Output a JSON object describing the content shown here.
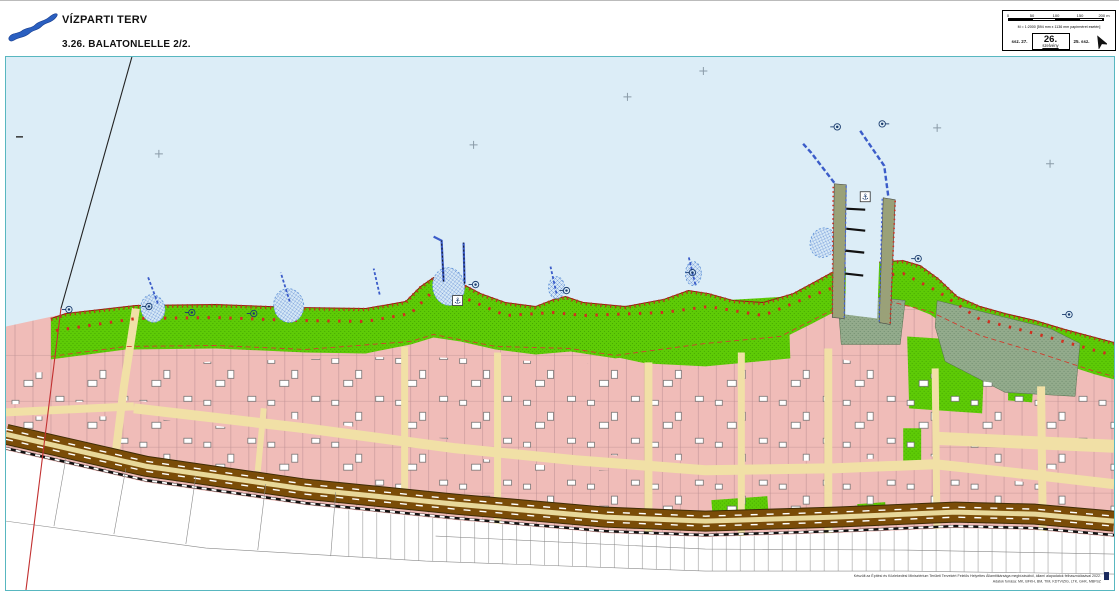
{
  "header": {
    "title": "VÍZPARTI TERV",
    "subtitle": "3.26. BALATONLELLE  2/2."
  },
  "titleblock": {
    "scale_ticks": [
      "0",
      "50",
      "100",
      "150",
      "200 m"
    ],
    "scale_note": "M = 1:2000 [594 mm x 1136 mm papírméret esetén]",
    "prev_sheet": "ssz. 27.",
    "sheet_number": "26.",
    "sheet_label": "szelvény",
    "next_sheet": "25. ssz."
  },
  "map": {
    "credit_line1": "Készült az Építési és Közlekedési Minisztérium Területi Tervekért Felelős Helyettes Államtitkársága megbízásából, állami alapadatok felhasználásával 2022.",
    "credit_line2": "Adatok forrása: MK, BFKH, BM, TIM, KDTVIZIG, LTK, GHK, MBFSZ",
    "anchor_symbol": "⚓",
    "colors": {
      "water": "#dcedf7",
      "green": "#5ecb06",
      "sage": "#93ab8c",
      "pink": "#f0bcb8",
      "street": "#f2e2a9",
      "road": "#7a4c08",
      "red": "#d03020",
      "reed": "#d6e8f6",
      "frame": "#58b7c0",
      "pier": "#9aa178",
      "blue": "#3b5cc9"
    }
  }
}
